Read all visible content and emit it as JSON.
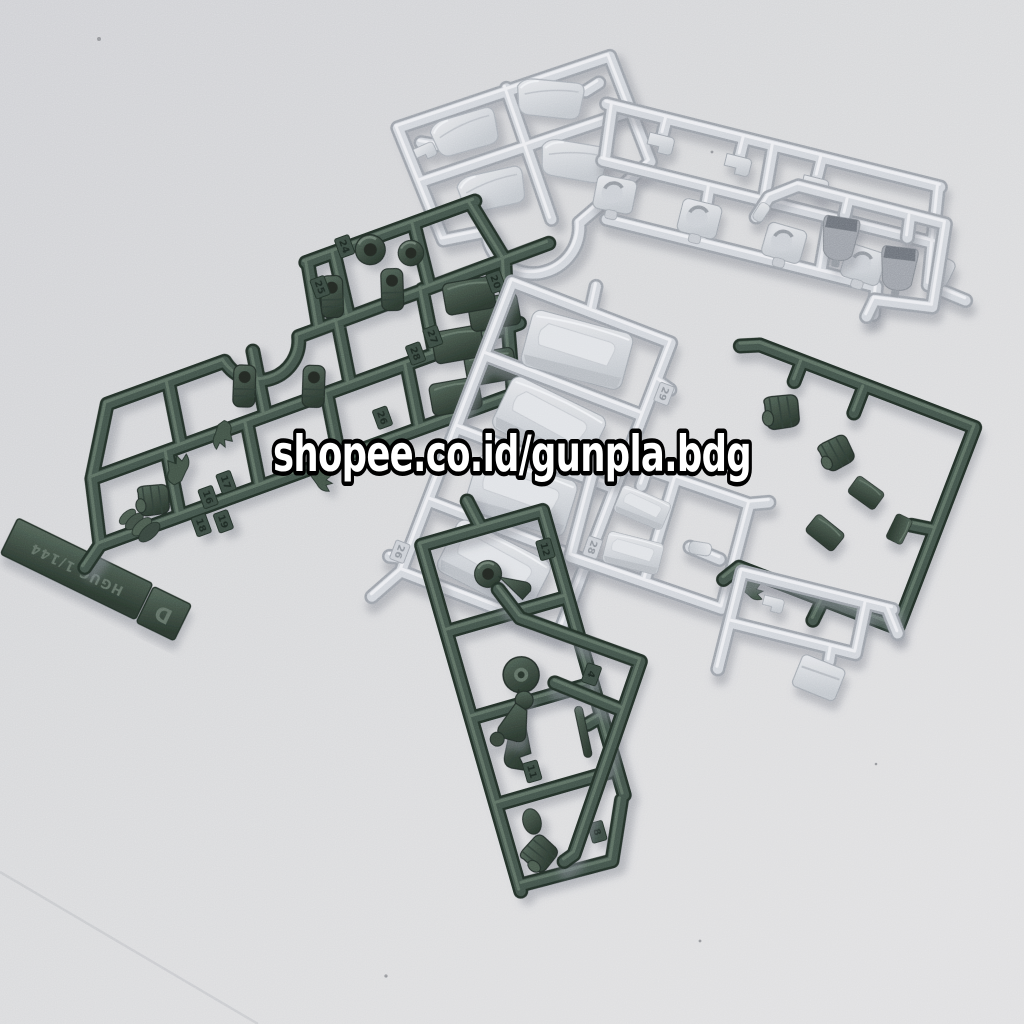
{
  "image": {
    "alt": "Photo of gunpla (Gundam plastic model kit) runner sprues in dark green and light gray plastic laid on a light gray surface",
    "width_px": 1024,
    "height_px": 1024
  },
  "watermark": {
    "text": "shopee.co.id/gunpla.bdg",
    "fill": "#ffffff",
    "outline": "#000000"
  },
  "palette": {
    "background": "#d4d5d8",
    "plastic_light_gray": "#ced2d8",
    "plastic_light_gray_shadow": "#9aa0a8",
    "plastic_two_tone_gray": "#676d75",
    "plastic_dark_green": "#3c4e44",
    "plastic_dark_green_edge": "#1e2a23"
  },
  "sprues": {
    "gray_armor_top": {
      "label": "light gray armor sprue with curved plates and arc runner"
    },
    "gray_strip_topright": {
      "label": "light gray strip sprue with brackets and socket joints"
    },
    "gray_shield_runner": {
      "label": "gray runner with two-tone backpack parts"
    },
    "green_d": {
      "label": "dark green sprue D with joints, hands and plates",
      "nameplate_text": "HGUC 1/144",
      "letter": "D",
      "tags": [
        "24",
        "25",
        "20",
        "28",
        "27",
        "26",
        "16",
        "17",
        "18",
        "19"
      ]
    },
    "gray_center": {
      "label": "light gray ladder sprue with large armor boxes",
      "tags": [
        "29",
        "28",
        "26"
      ]
    },
    "gray_small_right": {
      "label": "small light gray sprue with two box parts",
      "tags": [
        "25",
        "28"
      ]
    },
    "green_right": {
      "label": "dark green manipulator sprue with fists"
    },
    "gray_fragment": {
      "label": "small light gray runner fragment with box part"
    },
    "green_bottom": {
      "label": "dark green sprue with ring, lever and fist",
      "tags": [
        "12",
        "11",
        "8"
      ]
    },
    "green_corner": {
      "label": "dark green corner runner with arm part",
      "tags": [
        "4"
      ]
    }
  }
}
